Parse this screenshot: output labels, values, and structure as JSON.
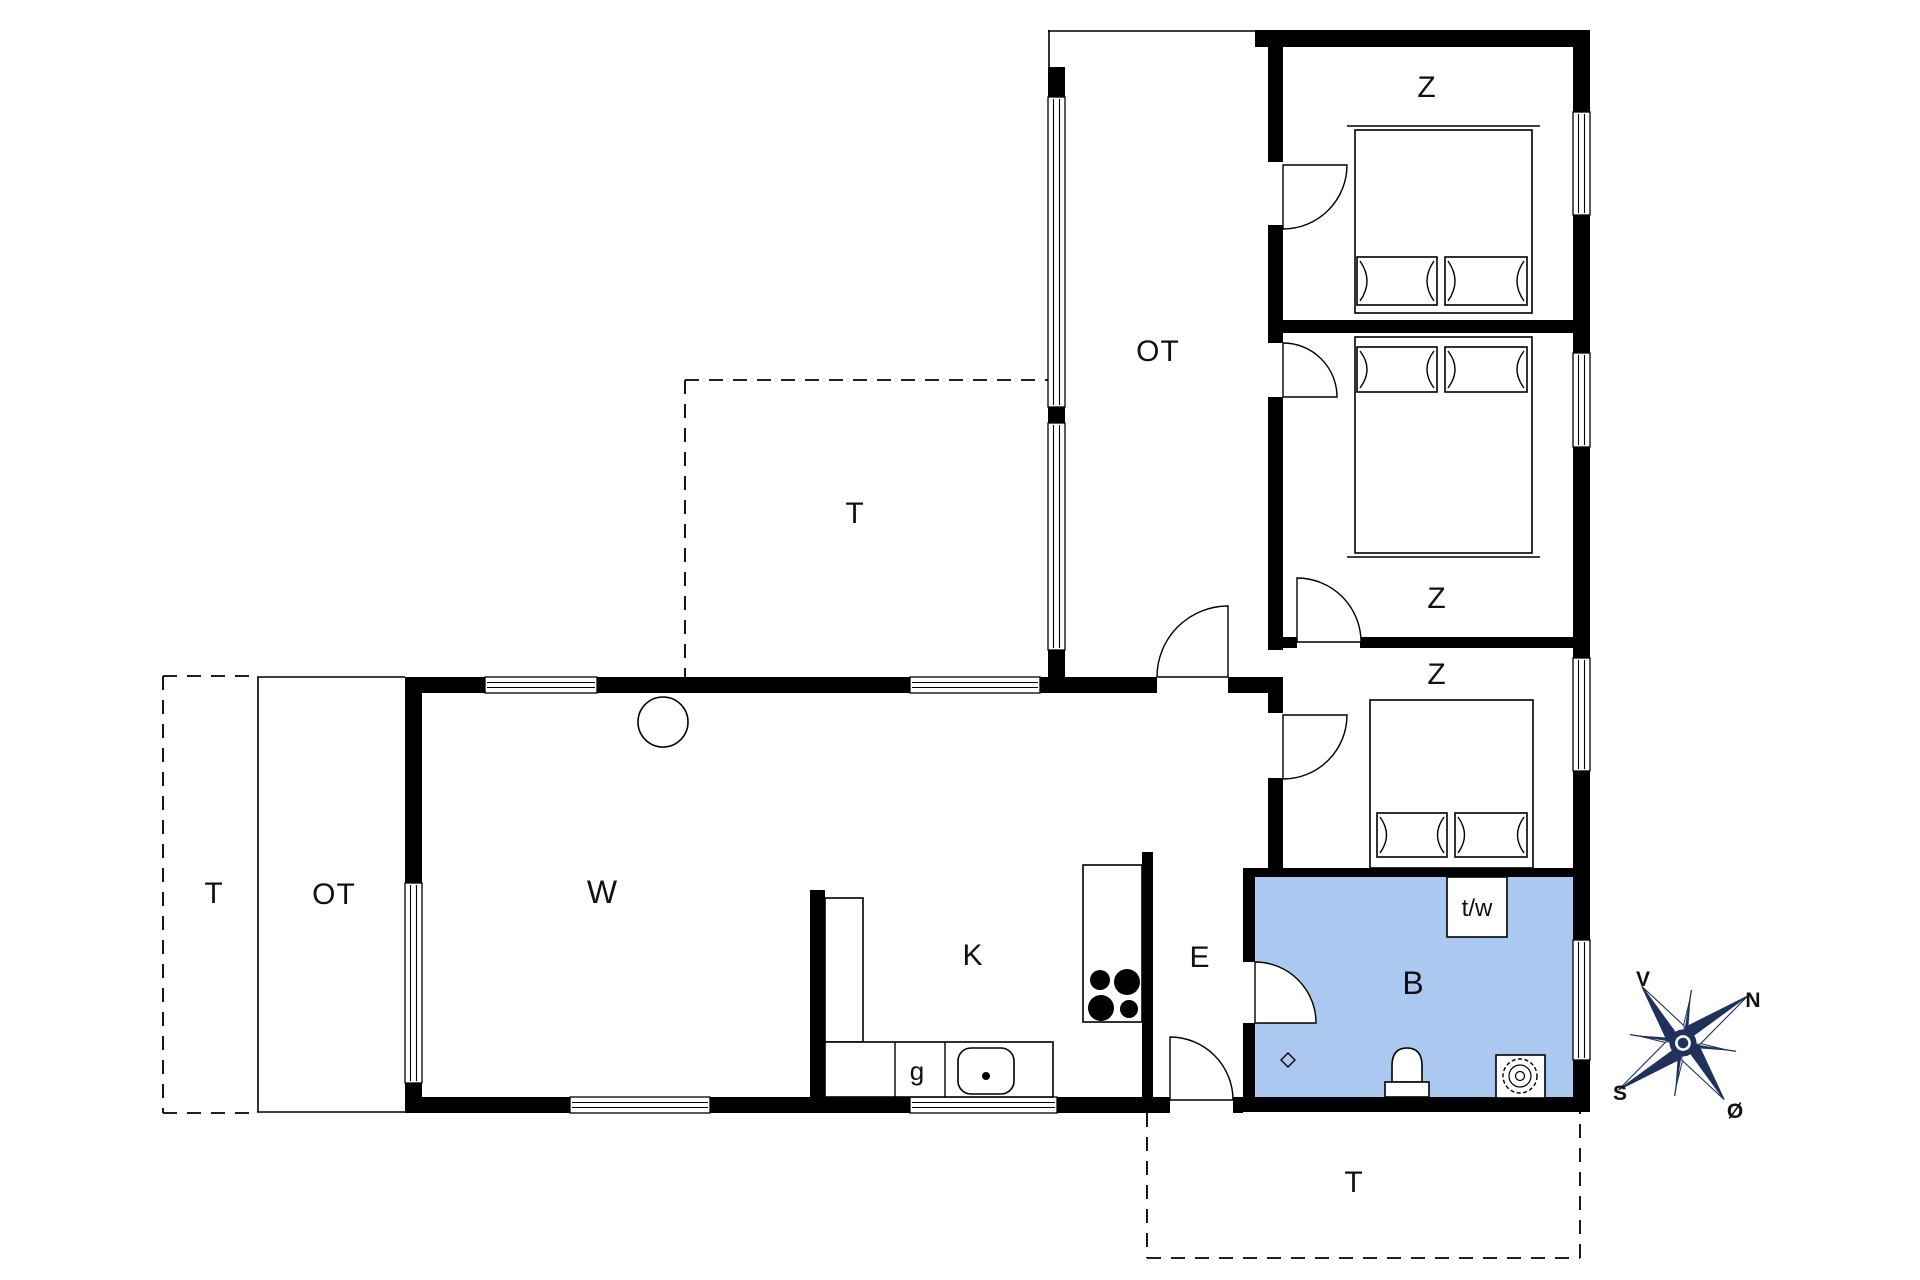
{
  "colors": {
    "background": "#ffffff",
    "walls": "#000000",
    "bathroom_fill": "#abc8f0",
    "compass": "#20315a",
    "label_text": "#111111"
  },
  "rooms": {
    "living_room": {
      "label": "W"
    },
    "kitchen": {
      "label": "K"
    },
    "wardrobe": {
      "label": "g"
    },
    "entry": {
      "label": "E"
    },
    "bathroom": {
      "label": "B"
    },
    "washer_dryer": {
      "label": "t/w"
    },
    "corridor_covered_terrace": {
      "label": "OT"
    },
    "covered_terrace_west": {
      "label": "OT"
    },
    "bedrooms": [
      {
        "label": "Z"
      },
      {
        "label": "Z"
      },
      {
        "label": "Z"
      }
    ],
    "terrace_north": {
      "label": "T"
    },
    "terrace_west": {
      "label": "T"
    },
    "terrace_south": {
      "label": "T"
    }
  },
  "compass": {
    "west": "V",
    "north": "N",
    "south": "S",
    "east": "Ø"
  }
}
